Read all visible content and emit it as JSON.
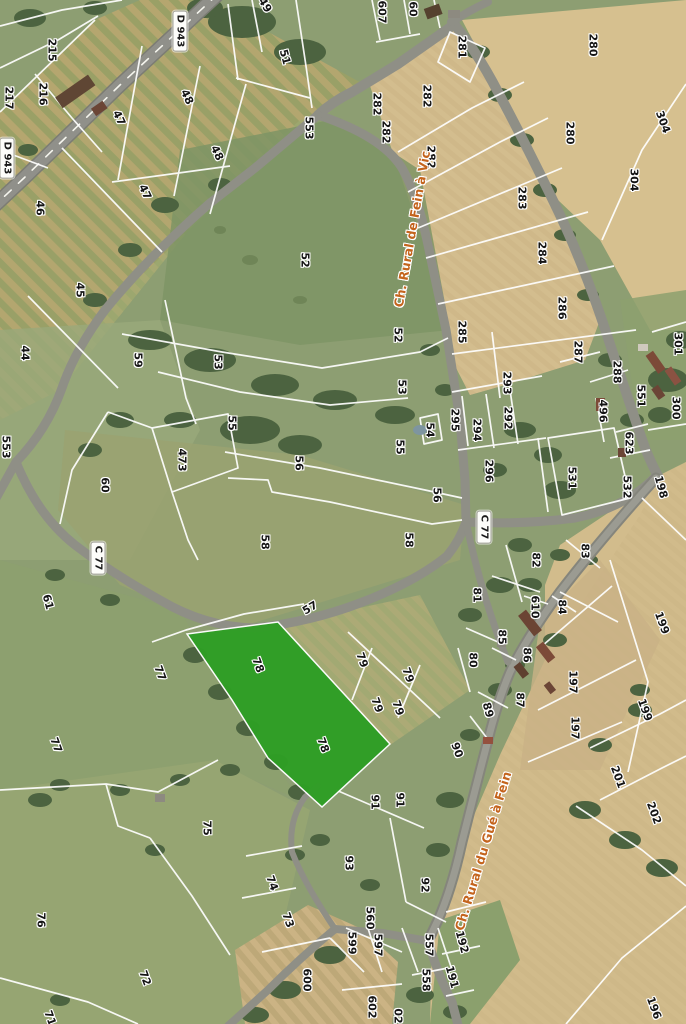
{
  "map": {
    "colors": {
      "highlight_parcel": "#2f9e25",
      "road_name_text": "#c4641d",
      "parcel_boundary": "#ffffff",
      "shield_background": "#fdfdfa",
      "aerial_grass": "#8d9e72",
      "aerial_cropfield": "#d3bd8e"
    },
    "road_shields": [
      {
        "t": "D 943",
        "x": 180,
        "y": 31,
        "r": 90
      },
      {
        "t": "D 943",
        "x": 7,
        "y": 158,
        "r": 90
      },
      {
        "t": "C 77",
        "x": 98,
        "y": 558,
        "r": 90
      },
      {
        "t": "C 77",
        "x": 484,
        "y": 527,
        "r": 90
      }
    ],
    "road_names": [
      {
        "t": "Ch. Rural de Fein à Vic",
        "x": 412,
        "y": 229,
        "r": -80
      },
      {
        "t": "Ch. Rural du Gué à Fein",
        "x": 483,
        "y": 851,
        "r": -73
      }
    ],
    "parcel_labels": [
      {
        "t": "215",
        "x": 52,
        "y": 50,
        "r": 90
      },
      {
        "t": "216",
        "x": 43,
        "y": 94,
        "r": 90
      },
      {
        "t": "217",
        "x": 9,
        "y": 98,
        "r": 90
      },
      {
        "t": "47",
        "x": 119,
        "y": 118,
        "r": 65
      },
      {
        "t": "48",
        "x": 187,
        "y": 97,
        "r": 65
      },
      {
        "t": "48",
        "x": 217,
        "y": 153,
        "r": 65
      },
      {
        "t": "47",
        "x": 145,
        "y": 192,
        "r": 65
      },
      {
        "t": "46",
        "x": 40,
        "y": 208,
        "r": 90
      },
      {
        "t": "45",
        "x": 80,
        "y": 290,
        "r": 90
      },
      {
        "t": "44",
        "x": 25,
        "y": 353,
        "r": 90
      },
      {
        "t": "59",
        "x": 138,
        "y": 360,
        "r": 90
      },
      {
        "t": "53",
        "x": 218,
        "y": 362,
        "r": 90
      },
      {
        "t": "49",
        "x": 265,
        "y": 5,
        "r": 60
      },
      {
        "t": "51",
        "x": 285,
        "y": 57,
        "r": 75
      },
      {
        "t": "607",
        "x": 382,
        "y": 12,
        "r": 90
      },
      {
        "t": "60",
        "x": 413,
        "y": 9,
        "r": 90
      },
      {
        "t": "281",
        "x": 462,
        "y": 47,
        "r": 90
      },
      {
        "t": "282",
        "x": 377,
        "y": 104,
        "r": 90
      },
      {
        "t": "282",
        "x": 386,
        "y": 132,
        "r": 90
      },
      {
        "t": "282",
        "x": 427,
        "y": 96,
        "r": 90
      },
      {
        "t": "282",
        "x": 431,
        "y": 157,
        "r": 90
      },
      {
        "t": "553",
        "x": 309,
        "y": 128,
        "r": 90
      },
      {
        "t": "280",
        "x": 593,
        "y": 45,
        "r": 90
      },
      {
        "t": "280",
        "x": 570,
        "y": 133,
        "r": 90
      },
      {
        "t": "304",
        "x": 663,
        "y": 122,
        "r": 70
      },
      {
        "t": "304",
        "x": 634,
        "y": 180,
        "r": 90
      },
      {
        "t": "283",
        "x": 522,
        "y": 198,
        "r": 90
      },
      {
        "t": "284",
        "x": 542,
        "y": 253,
        "r": 90
      },
      {
        "t": "286",
        "x": 562,
        "y": 308,
        "r": 90
      },
      {
        "t": "285",
        "x": 462,
        "y": 332,
        "r": 90
      },
      {
        "t": "301",
        "x": 678,
        "y": 344,
        "r": 90
      },
      {
        "t": "287",
        "x": 578,
        "y": 352,
        "r": 90
      },
      {
        "t": "288",
        "x": 617,
        "y": 372,
        "r": 90
      },
      {
        "t": "293",
        "x": 507,
        "y": 383,
        "r": 90
      },
      {
        "t": "551",
        "x": 641,
        "y": 396,
        "r": 90
      },
      {
        "t": "52",
        "x": 305,
        "y": 260,
        "r": 90
      },
      {
        "t": "52",
        "x": 398,
        "y": 335,
        "r": 90
      },
      {
        "t": "53",
        "x": 402,
        "y": 387,
        "r": 90
      },
      {
        "t": "553",
        "x": 6,
        "y": 447,
        "r": 90
      },
      {
        "t": "60",
        "x": 105,
        "y": 485,
        "r": 90
      },
      {
        "t": "473",
        "x": 182,
        "y": 460,
        "r": 90
      },
      {
        "t": "55",
        "x": 232,
        "y": 423,
        "r": 90
      },
      {
        "t": "55",
        "x": 400,
        "y": 447,
        "r": 90
      },
      {
        "t": "54",
        "x": 430,
        "y": 430,
        "r": 90
      },
      {
        "t": "295",
        "x": 455,
        "y": 420,
        "r": 90
      },
      {
        "t": "294",
        "x": 477,
        "y": 430,
        "r": 90
      },
      {
        "t": "292",
        "x": 508,
        "y": 418,
        "r": 90
      },
      {
        "t": "296",
        "x": 489,
        "y": 471,
        "r": 90
      },
      {
        "t": "531",
        "x": 572,
        "y": 478,
        "r": 90
      },
      {
        "t": "496",
        "x": 603,
        "y": 411,
        "r": 90
      },
      {
        "t": "623",
        "x": 629,
        "y": 443,
        "r": 90
      },
      {
        "t": "532",
        "x": 627,
        "y": 487,
        "r": 90
      },
      {
        "t": "300",
        "x": 676,
        "y": 408,
        "r": 90
      },
      {
        "t": "198",
        "x": 661,
        "y": 487,
        "r": 75
      },
      {
        "t": "56",
        "x": 299,
        "y": 463,
        "r": 90
      },
      {
        "t": "56",
        "x": 437,
        "y": 495,
        "r": 90
      },
      {
        "t": "58",
        "x": 265,
        "y": 542,
        "r": 90
      },
      {
        "t": "58",
        "x": 409,
        "y": 540,
        "r": 90
      },
      {
        "t": "61",
        "x": 48,
        "y": 602,
        "r": 75
      },
      {
        "t": "82",
        "x": 536,
        "y": 560,
        "r": 90
      },
      {
        "t": "83",
        "x": 585,
        "y": 551,
        "r": 90
      },
      {
        "t": "81",
        "x": 477,
        "y": 595,
        "r": 90
      },
      {
        "t": "77",
        "x": 160,
        "y": 673,
        "r": 70
      },
      {
        "t": "77",
        "x": 56,
        "y": 745,
        "r": 70
      },
      {
        "t": "57",
        "x": 310,
        "y": 608,
        "r": -30
      },
      {
        "t": "78",
        "x": 258,
        "y": 665,
        "r": 70
      },
      {
        "t": "78",
        "x": 323,
        "y": 745,
        "r": 70
      },
      {
        "t": "79",
        "x": 362,
        "y": 660,
        "r": 70
      },
      {
        "t": "79",
        "x": 408,
        "y": 675,
        "r": 70
      },
      {
        "t": "79",
        "x": 377,
        "y": 705,
        "r": 70
      },
      {
        "t": "79",
        "x": 398,
        "y": 708,
        "r": 70
      },
      {
        "t": "90",
        "x": 457,
        "y": 750,
        "r": 70
      },
      {
        "t": "610",
        "x": 535,
        "y": 607,
        "r": 90
      },
      {
        "t": "84",
        "x": 562,
        "y": 607,
        "r": 90
      },
      {
        "t": "85",
        "x": 502,
        "y": 637,
        "r": 90
      },
      {
        "t": "86",
        "x": 527,
        "y": 655,
        "r": 90
      },
      {
        "t": "80",
        "x": 473,
        "y": 660,
        "r": 90
      },
      {
        "t": "87",
        "x": 520,
        "y": 700,
        "r": 90
      },
      {
        "t": "89",
        "x": 488,
        "y": 710,
        "r": 75
      },
      {
        "t": "197",
        "x": 573,
        "y": 682,
        "r": 90
      },
      {
        "t": "197",
        "x": 575,
        "y": 728,
        "r": 90
      },
      {
        "t": "199",
        "x": 662,
        "y": 623,
        "r": 70
      },
      {
        "t": "199",
        "x": 645,
        "y": 710,
        "r": 70
      },
      {
        "t": "201",
        "x": 618,
        "y": 777,
        "r": 70
      },
      {
        "t": "202",
        "x": 654,
        "y": 813,
        "r": 70
      },
      {
        "t": "196",
        "x": 654,
        "y": 1008,
        "r": 70
      },
      {
        "t": "75",
        "x": 207,
        "y": 828,
        "r": 90
      },
      {
        "t": "76",
        "x": 41,
        "y": 920,
        "r": 90
      },
      {
        "t": "72",
        "x": 145,
        "y": 978,
        "r": 70
      },
      {
        "t": "71",
        "x": 50,
        "y": 1018,
        "r": 70
      },
      {
        "t": "91",
        "x": 375,
        "y": 802,
        "r": 90
      },
      {
        "t": "91",
        "x": 400,
        "y": 800,
        "r": 90
      },
      {
        "t": "93",
        "x": 349,
        "y": 863,
        "r": 90
      },
      {
        "t": "92",
        "x": 425,
        "y": 885,
        "r": 90
      },
      {
        "t": "74",
        "x": 272,
        "y": 883,
        "r": 70
      },
      {
        "t": "73",
        "x": 288,
        "y": 920,
        "r": 70
      },
      {
        "t": "560",
        "x": 370,
        "y": 918,
        "r": 90
      },
      {
        "t": "599",
        "x": 352,
        "y": 943,
        "r": 90
      },
      {
        "t": "597",
        "x": 378,
        "y": 945,
        "r": 90
      },
      {
        "t": "557",
        "x": 429,
        "y": 945,
        "r": 90
      },
      {
        "t": "600",
        "x": 307,
        "y": 980,
        "r": 90
      },
      {
        "t": "558",
        "x": 426,
        "y": 980,
        "r": 90
      },
      {
        "t": "602",
        "x": 372,
        "y": 1007,
        "r": 90
      },
      {
        "t": "02",
        "x": 398,
        "y": 1016,
        "r": 90
      },
      {
        "t": "192",
        "x": 462,
        "y": 942,
        "r": 75
      },
      {
        "t": "191",
        "x": 452,
        "y": 977,
        "r": 75
      }
    ]
  }
}
